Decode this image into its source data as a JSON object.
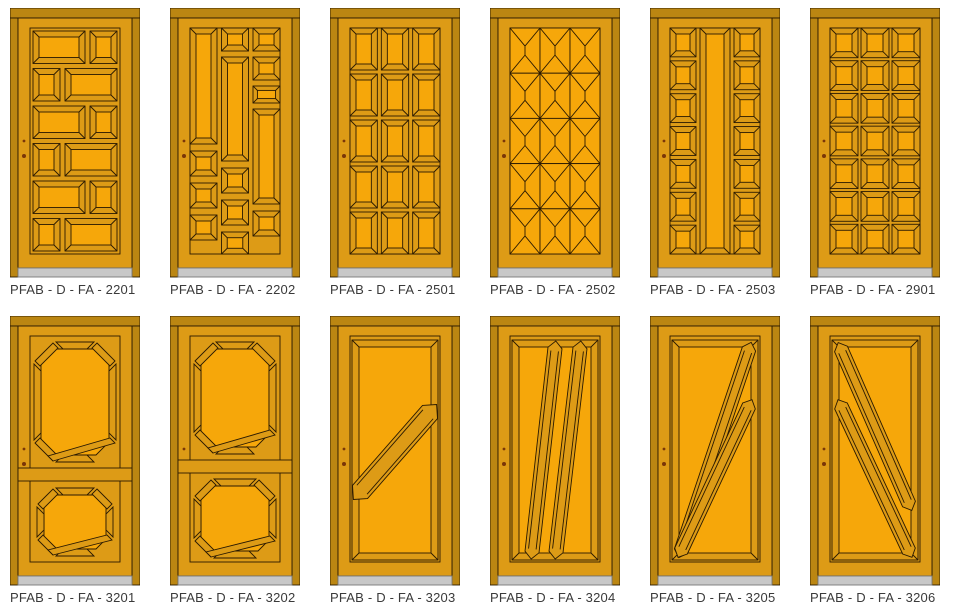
{
  "catalog": {
    "rows": 2,
    "columns": 6,
    "item_count": 12
  },
  "colors": {
    "background": "#ffffff",
    "frame": "#bb8612",
    "leaf": "#dd9b16",
    "mid": "#dd9b16",
    "bright": "#f6a70a",
    "outline": "#2a1a02",
    "threshold": "#c8c8c8",
    "threshold_edge": "#777777",
    "handle": "#7a3608",
    "label_text": "#3a3a3a"
  },
  "doors": [
    {
      "label": "PFAB - D - FA - 2201",
      "design": {
        "type": "alt_rows",
        "rows": 6,
        "wide": 52,
        "narrow": 27,
        "gap": 5
      }
    },
    {
      "label": "PFAB - D - FA - 2202",
      "design": {
        "type": "columns",
        "cols": [
          [
            {
              "t": "strip",
              "y": 0,
              "h": 116
            },
            {
              "t": "sq",
              "y": 123,
              "h": 25
            },
            {
              "t": "sq",
              "y": 155,
              "h": 25
            },
            {
              "t": "sq",
              "y": 187,
              "h": 25
            }
          ],
          [
            {
              "t": "sq",
              "y": 0,
              "h": 23
            },
            {
              "t": "strip",
              "y": 29,
              "h": 104
            },
            {
              "t": "sq",
              "y": 140,
              "h": 25
            },
            {
              "t": "sq",
              "y": 172,
              "h": 25
            },
            {
              "t": "sq",
              "y": 204,
              "h": 22
            }
          ],
          [
            {
              "t": "sq",
              "y": 0,
              "h": 23
            },
            {
              "t": "sq",
              "y": 29,
              "h": 23
            },
            {
              "t": "sq",
              "y": 58,
              "h": 17
            },
            {
              "t": "strip",
              "y": 81,
              "h": 95
            },
            {
              "t": "sq",
              "y": 183,
              "h": 25
            }
          ]
        ]
      }
    },
    {
      "label": "PFAB - D - FA - 2501",
      "design": {
        "type": "grid_bevel",
        "cols": 3,
        "rows": 5,
        "gap": 4
      }
    },
    {
      "label": "PFAB - D - FA - 2502",
      "design": {
        "type": "grid_x",
        "cols": 3,
        "rows": 5
      }
    },
    {
      "label": "PFAB - D - FA - 2503",
      "design": {
        "type": "squares_strip_squares",
        "squares": 7
      }
    },
    {
      "label": "PFAB - D - FA - 2901",
      "design": {
        "type": "grid_bevel",
        "cols": 3,
        "rows": 7,
        "gap": 3
      }
    },
    {
      "label": "PFAB - D - FA - 3201",
      "design": {
        "type": "two_octagons",
        "top": [
          24,
          26,
          82,
          120,
          17
        ],
        "rail": [
          152,
          13
        ],
        "bottom": [
          27,
          172,
          76,
          68,
          14
        ]
      }
    },
    {
      "label": "PFAB - D - FA - 3202",
      "design": {
        "type": "two_octagons",
        "top": [
          24,
          26,
          82,
          112,
          17
        ],
        "rail": [
          144,
          13
        ],
        "bottom": [
          24,
          163,
          82,
          79,
          15
        ]
      }
    },
    {
      "label": "PFAB - D - FA - 3203",
      "design": {
        "type": "panel_diagonals",
        "strips": [
          [
            30,
            176,
            100,
            96,
            10
          ]
        ]
      }
    },
    {
      "label": "PFAB - D - FA - 3204",
      "design": {
        "type": "panel_diagonals",
        "strips": [
          [
            42,
            236,
            65,
            32,
            7
          ],
          [
            66,
            236,
            90,
            32,
            7
          ]
        ]
      }
    },
    {
      "label": "PFAB - D - FA - 3205",
      "design": {
        "type": "panel_diagonals",
        "strips": [
          [
            31,
            235,
            99,
            33,
            7
          ],
          [
            31,
            235,
            99,
            90,
            7
          ]
        ]
      }
    },
    {
      "label": "PFAB - D - FA - 3206",
      "design": {
        "type": "panel_diagonals",
        "strips": [
          [
            31,
            33,
            99,
            188,
            7
          ],
          [
            31,
            90,
            99,
            235,
            7
          ]
        ]
      }
    }
  ]
}
